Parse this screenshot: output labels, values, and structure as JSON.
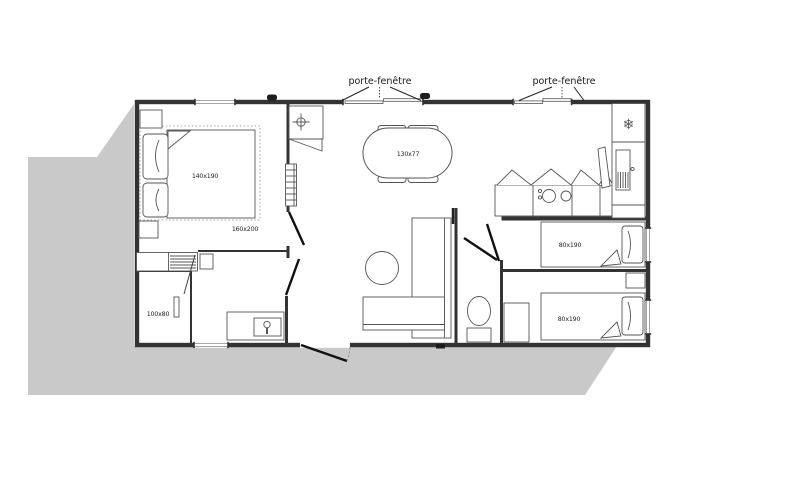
{
  "plan": {
    "type": "floor-plan",
    "annotations": {
      "porte_fenetre_left": "porte-fenêtre",
      "porte_fenetre_right": "porte-fenêtre"
    },
    "rooms": {
      "master_bedroom": {
        "bed_dimension": "140x190",
        "bed_area_dimension": "160x200"
      },
      "bathroom": {
        "shower_dimension": "100x80"
      },
      "living_room": {
        "table_dimension": "130x77"
      },
      "bedroom_1": {
        "bed_dimension": "80x190"
      },
      "bedroom_2": {
        "bed_dimension": "80x190"
      }
    },
    "icons": {
      "fridge_snowflake": "❄"
    },
    "colors": {
      "background": "#ffffff",
      "shadow": "#c9c9c9",
      "wall": "#333333",
      "furniture": "#555555"
    }
  }
}
